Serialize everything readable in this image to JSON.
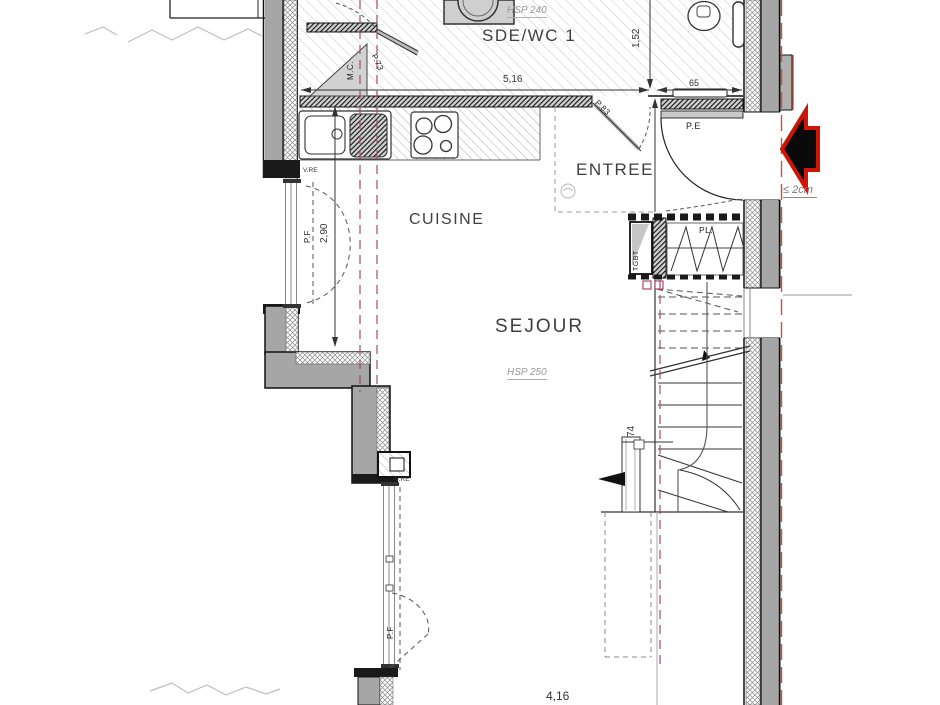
{
  "rooms": {
    "sdewc": "SDE/WC 1",
    "cuisine": "CUISINE",
    "sejour": "SEJOUR",
    "entree": "ENTREE"
  },
  "ceiling_heights": {
    "sdewc": "HSP 240",
    "sejour": "HSP 250"
  },
  "dimensions": {
    "sde_width": "5,16",
    "sde_depth": "1,52",
    "entry_recess": "65",
    "bay_height": "2,90",
    "stair_width": "74",
    "sejour_width": "4,16"
  },
  "annotations": {
    "threshold": "≤ 2cm"
  },
  "doors": {
    "entry": "P.E",
    "wc": "P.83",
    "service": "P.73",
    "bay_upper": "P.F",
    "bay_lower": "P.F"
  },
  "fixtures": {
    "closet_mc": "M.C.",
    "panel_tgbt": "TGBT",
    "closet_pl": "PL.",
    "shutter_upper": "V.RE",
    "shutter_lower": "V.RE"
  },
  "colors": {
    "arrow_red": "#cc1607",
    "axis_magenta": "#a84a66",
    "wall_gray": "#a6a6a6"
  }
}
